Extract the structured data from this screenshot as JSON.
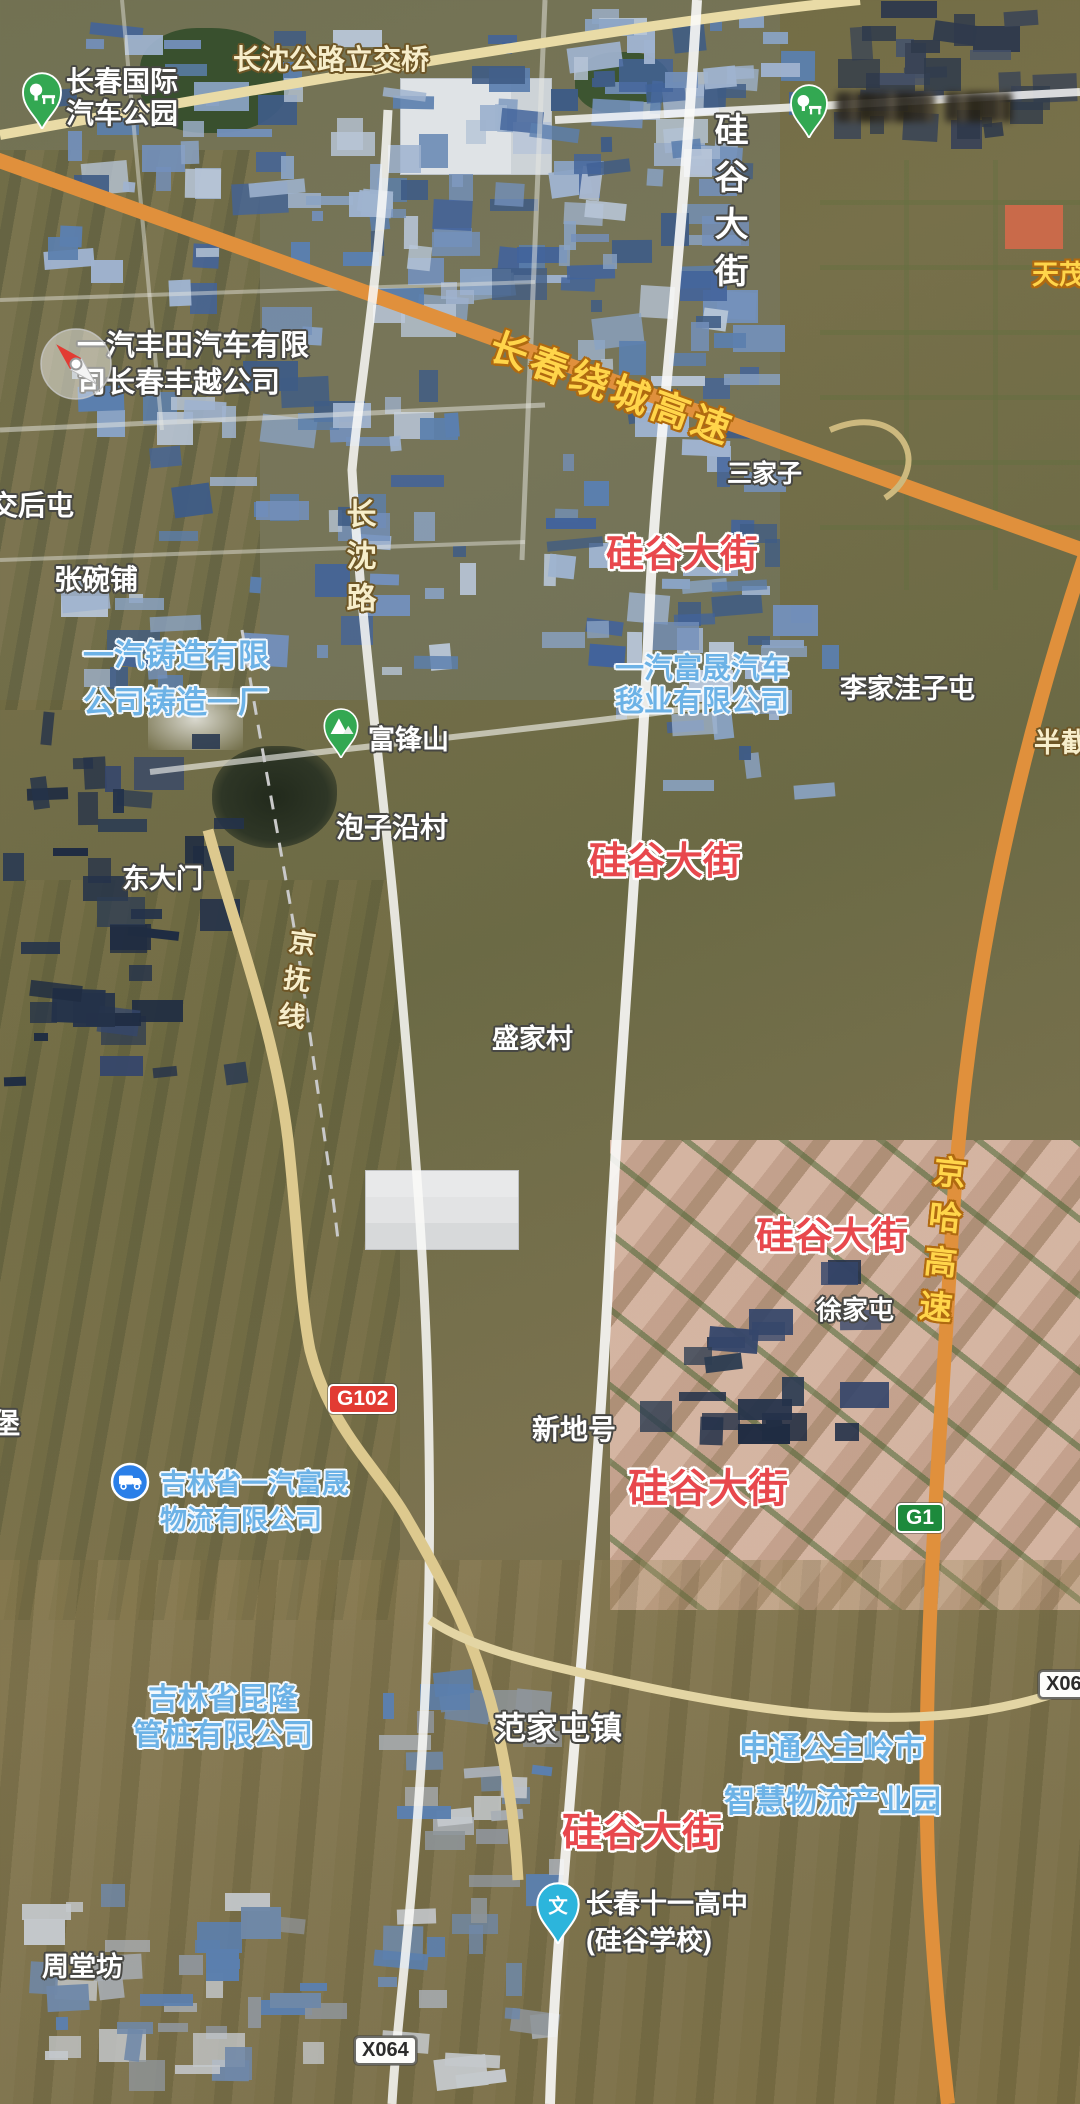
{
  "map": {
    "pins": [
      {
        "name": "park-pin-auto-park",
        "type": "park",
        "x": 20,
        "y": 72,
        "w": 44,
        "h": 57,
        "color": "#33a852"
      },
      {
        "name": "park-pin-top-right",
        "type": "park",
        "x": 788,
        "y": 84,
        "w": 42,
        "h": 54,
        "color": "#33a852"
      },
      {
        "name": "compass-pin-faw-toyota",
        "type": "compass",
        "x": 38,
        "y": 326,
        "w": 76,
        "h": 76
      },
      {
        "name": "mountain-pin-fufengshan",
        "type": "mountain",
        "x": 322,
        "y": 708,
        "w": 38,
        "h": 50,
        "color": "#33a852"
      },
      {
        "name": "logistics-pin-truck",
        "type": "truck",
        "x": 110,
        "y": 1462,
        "w": 40,
        "h": 40,
        "color": "#2a7fe8"
      },
      {
        "name": "school-pin-wen",
        "type": "school",
        "x": 534,
        "y": 1882,
        "w": 48,
        "h": 62,
        "color": "#2cb5dc"
      }
    ],
    "labels": [
      {
        "name": "poi-label-changchun-intl-auto-park",
        "lines": [
          "长春国际",
          "汽车公园"
        ],
        "x": 66,
        "y": 66,
        "size": 28,
        "style": "white",
        "interactable": true
      },
      {
        "name": "road-label-changshen-overpass",
        "text": "长沈公路立交桥",
        "x": 233,
        "y": 44,
        "size": 28,
        "style": "cream",
        "interactable": false
      },
      {
        "name": "road-label-guigu-dajie-north",
        "text": "硅谷大街",
        "x": 708,
        "y": 112,
        "size": 34,
        "style": "white",
        "vertical": true,
        "spacing": 13,
        "interactable": false
      },
      {
        "name": "poi-label-tianmao-lake",
        "text": "天茂湖",
        "x": 1032,
        "y": 260,
        "size": 27,
        "style": "yellow",
        "interactable": true
      },
      {
        "name": "road-label-raocheng-expressway",
        "text": "长春绕城高速",
        "x": 498,
        "y": 326,
        "size": 38,
        "style": "yellow",
        "rotate": 20,
        "spacing": 5,
        "interactable": false
      },
      {
        "name": "poi-label-faw-toyota",
        "lines": [
          "一汽丰田汽车有限",
          "司长春丰越公司"
        ],
        "x": 77,
        "y": 328,
        "size": 29,
        "style": "white",
        "lh": 37,
        "interactable": true
      },
      {
        "name": "poi-label-sanjiazi",
        "text": "三家子",
        "x": 727,
        "y": 460,
        "size": 25,
        "style": "white",
        "interactable": true
      },
      {
        "name": "road-label-guigu-dajie-1",
        "text": "硅谷大街",
        "x": 606,
        "y": 534,
        "size": 38,
        "style": "red",
        "interactable": false
      },
      {
        "name": "poi-label-jiaohoutun",
        "text": "交后屯",
        "x": -10,
        "y": 490,
        "size": 28,
        "style": "white",
        "interactable": true
      },
      {
        "name": "poi-label-zhangwanpu",
        "text": "张碗铺",
        "x": 54,
        "y": 564,
        "size": 28,
        "style": "white",
        "interactable": true
      },
      {
        "name": "road-label-changshen-lu",
        "text": "长沈路",
        "x": 340,
        "y": 498,
        "size": 30,
        "style": "cream",
        "vertical": true,
        "spacing": 12,
        "interactable": false
      },
      {
        "name": "poi-label-faw-casting",
        "lines": [
          "一汽铸造有限",
          "公司铸造一厂"
        ],
        "x": 83,
        "y": 632,
        "size": 31,
        "style": "blue",
        "lh": 47,
        "interactable": true
      },
      {
        "name": "poi-label-faw-fusheng-tanye",
        "lines": [
          "一汽富晟汽车",
          "毯业有限公司"
        ],
        "x": 615,
        "y": 653,
        "size": 29,
        "style": "blue",
        "lh": 33,
        "interactable": true
      },
      {
        "name": "poi-label-lijiawazitun",
        "text": "李家洼子屯",
        "x": 840,
        "y": 674,
        "size": 27,
        "style": "white",
        "interactable": true
      },
      {
        "name": "poi-label-banjie",
        "text": "半截",
        "x": 1034,
        "y": 728,
        "size": 27,
        "style": "cream",
        "interactable": true
      },
      {
        "name": "poi-label-fufengshan",
        "text": "富锋山",
        "x": 368,
        "y": 725,
        "size": 27,
        "style": "white",
        "interactable": true
      },
      {
        "name": "poi-label-paoziyancun",
        "text": "泡子沿村",
        "x": 336,
        "y": 812,
        "size": 28,
        "style": "white",
        "interactable": true
      },
      {
        "name": "road-label-guigu-dajie-2",
        "text": "硅谷大街",
        "x": 589,
        "y": 841,
        "size": 38,
        "style": "red",
        "interactable": false
      },
      {
        "name": "poi-label-dongdamen",
        "text": "东大门",
        "x": 122,
        "y": 864,
        "size": 27,
        "style": "white",
        "interactable": true
      },
      {
        "name": "road-label-jingfu-line",
        "text": "京抚线",
        "x": 286,
        "y": 926,
        "size": 27,
        "style": "cream",
        "vertical": true,
        "spacing": 10,
        "rotate": 8,
        "interactable": false
      },
      {
        "name": "poi-label-shengjiacun",
        "text": "盛家村",
        "x": 492,
        "y": 1024,
        "size": 27,
        "style": "white",
        "interactable": true
      },
      {
        "name": "road-label-guigu-dajie-3",
        "text": "硅谷大街",
        "x": 756,
        "y": 1216,
        "size": 38,
        "style": "red",
        "interactable": false
      },
      {
        "name": "road-label-jingha-expressway",
        "text": "京哈高速",
        "x": 930,
        "y": 1153,
        "size": 33,
        "style": "yellow",
        "vertical": true,
        "spacing": 12,
        "rotate": 6,
        "interactable": false
      },
      {
        "name": "poi-label-xujiatun",
        "text": "徐家屯",
        "x": 816,
        "y": 1296,
        "size": 26,
        "style": "white",
        "interactable": true
      },
      {
        "name": "poi-label-xindihao",
        "text": "新地号",
        "x": 532,
        "y": 1414,
        "size": 28,
        "style": "white",
        "interactable": true
      },
      {
        "name": "poi-label-jilin-faw-fusheng-logistics",
        "lines": [
          "吉林省一汽富晟",
          "物流有限公司"
        ],
        "x": 160,
        "y": 1466,
        "size": 27,
        "style": "blue",
        "lh": 36,
        "interactable": true
      },
      {
        "name": "road-label-guigu-dajie-4",
        "text": "硅谷大街",
        "x": 628,
        "y": 1466,
        "size": 40,
        "style": "red",
        "interactable": false
      },
      {
        "name": "poi-label-jilin-kunlong",
        "lines": [
          "吉林省昆隆",
          "管桩有限公司"
        ],
        "x": 128,
        "y": 1682,
        "size": 30,
        "style": "blue",
        "lh": 36,
        "align": "center",
        "width": 190,
        "interactable": true
      },
      {
        "name": "poi-label-fanjiatunzhen",
        "text": "范家屯镇",
        "x": 494,
        "y": 1710,
        "size": 32,
        "style": "white",
        "interactable": true
      },
      {
        "name": "poi-label-shentong-logistics-park",
        "lines": [
          "申通公主岭市",
          "智慧物流产业园"
        ],
        "x": 724,
        "y": 1722,
        "size": 31,
        "style": "blue",
        "lh": 53,
        "align": "center",
        "width": 216,
        "interactable": true
      },
      {
        "name": "road-label-guigu-dajie-5",
        "text": "硅谷大街",
        "x": 562,
        "y": 1810,
        "size": 40,
        "style": "red",
        "interactable": false
      },
      {
        "name": "poi-label-changchun-no11-high-school",
        "lines": [
          "长春十一高中",
          "(硅谷学校)"
        ],
        "x": 586,
        "y": 1886,
        "size": 27,
        "style": "white",
        "lh": 37,
        "interactable": true
      },
      {
        "name": "poi-label-zhoutangfang",
        "text": "周堂坊",
        "x": 42,
        "y": 1952,
        "size": 27,
        "style": "white",
        "interactable": true
      },
      {
        "name": "poi-label-bu-clipped",
        "text": "堡",
        "x": -8,
        "y": 1408,
        "size": 28,
        "style": "white",
        "interactable": true
      }
    ],
    "badges": [
      {
        "name": "road-shield-g102",
        "text": "G102",
        "x": 328,
        "y": 1384,
        "style": "national"
      },
      {
        "name": "road-shield-g1",
        "text": "G1",
        "x": 896,
        "y": 1503,
        "style": "expressway"
      },
      {
        "name": "road-shield-x063",
        "text": "X063",
        "x": 1038,
        "y": 1670,
        "style": "county"
      },
      {
        "name": "road-shield-x064",
        "text": "X064",
        "x": 354,
        "y": 2036,
        "style": "county"
      }
    ],
    "redacted_label": {
      "x": 836,
      "y": 92,
      "w": 176,
      "h": 30
    },
    "palette": {
      "expressway_orange": "#e0903c",
      "minor_road_cream": "#ddc98e",
      "white_road": "#faf9f5",
      "poi_green": "#33a852",
      "poi_blue": "#2a7fe8",
      "school_cyan": "#2cb5dc",
      "label_red": "#e8484d",
      "label_yellow": "#ffd54a",
      "label_cream": "#f7eecb",
      "label_blue": "#6cb2e6"
    }
  }
}
